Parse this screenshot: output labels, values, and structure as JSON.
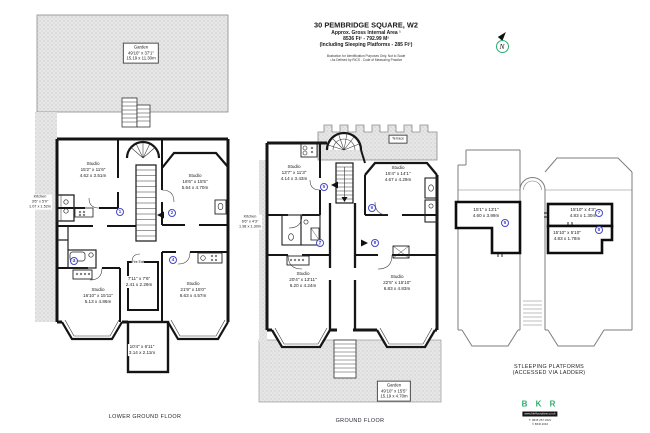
{
  "header": {
    "title": "30 PEMBRIDGE SQUARE, W2",
    "subtitle": "Approx. Gross Internal Area ¹",
    "area": "8536 Ft² - 792.99 M²",
    "including": "(Including Sleeping Platforms - 285 Ft²)",
    "disclaimer1": "Illustration for Identification Purposes Only, Not to Scale",
    "disclaimer2": "¹ As Defined by RICS - Code of Measuring Practice"
  },
  "compass": {
    "label": "N"
  },
  "lower_ground": {
    "floor_label": "LOWER GROUND FLOOR",
    "garden": {
      "name": "Garden",
      "imperial": "49'10\" x 37'1\"",
      "metric": "15.19 x 11.30m"
    },
    "fire_exit": "Fire Exit",
    "rooms": [
      {
        "name": "Studio",
        "imperial": "15'2\" x 11'6\"",
        "metric": "4.62 x 3.51m"
      },
      {
        "name": "Studio",
        "imperial": "18'6\" x 15'5\"",
        "metric": "5.64 x 4.70m"
      },
      {
        "name": "Kitchen",
        "imperial": "3'6\" x 5'0\"",
        "metric": "1.07 x 1.52m"
      },
      {
        "name": "",
        "imperial": "7'11\" x 7'6\"",
        "metric": "2.41 x 2.29m"
      },
      {
        "name": "Studio",
        "imperial": "16'10\" x 15'11\"",
        "metric": "5.13 x 4.86m"
      },
      {
        "name": "Studio",
        "imperial": "21'9\" x 15'0\"",
        "metric": "6.63 x 4.57m"
      },
      {
        "name": "",
        "imperial": "10'4\" x 6'11\"",
        "metric": "3.14 x 2.11m"
      }
    ],
    "units": [
      "1",
      "2",
      "3",
      "4"
    ]
  },
  "ground": {
    "floor_label": "GROUND FLOOR",
    "terrace_label": "Terrace",
    "garden": {
      "name": "Garden",
      "imperial": "49'10\" x 15'5\"",
      "metric": "15.19 x 4.70m"
    },
    "rooms": [
      {
        "name": "Studio",
        "imperial": "13'7\" x 11'3\"",
        "metric": "4.14 x 3.43m"
      },
      {
        "name": "Studio",
        "imperial": "15'4\" x 14'1\"",
        "metric": "4.67 x 4.29m"
      },
      {
        "name": "Kitchen",
        "imperial": "6'6\" x 4'3\"",
        "metric": "1.98 x 1.30m"
      },
      {
        "name": "Studio",
        "imperial": "20'4\" x 13'11\"",
        "metric": "6.20 x 4.24m"
      },
      {
        "name": "Studio",
        "imperial": "22'5\" x 15'10\"",
        "metric": "6.83 x 4.83m"
      }
    ],
    "units": [
      "5",
      "6",
      "7",
      "8"
    ]
  },
  "platforms": {
    "title_line1": "STLEEPING PLATFORMS",
    "title_line2": "(ACCESSED VIA LADDER)",
    "areas": [
      {
        "imperial": "15'1\" x 13'1\"",
        "metric": "4.60 x 3.99m",
        "unit": "5"
      },
      {
        "imperial": "15'10\" x 4'3\"",
        "metric": "4.83 x 1.30m",
        "unit": "7"
      },
      {
        "imperial": "15'10\" x 5'10\"",
        "metric": "4.83 x 1.78m",
        "unit": "8"
      }
    ]
  },
  "logo": {
    "name": "B K R",
    "website": "www.bkrfloorplans.co.uk",
    "phone": "T: 0845 257 0321",
    "copyright": "© BKR 2016"
  }
}
